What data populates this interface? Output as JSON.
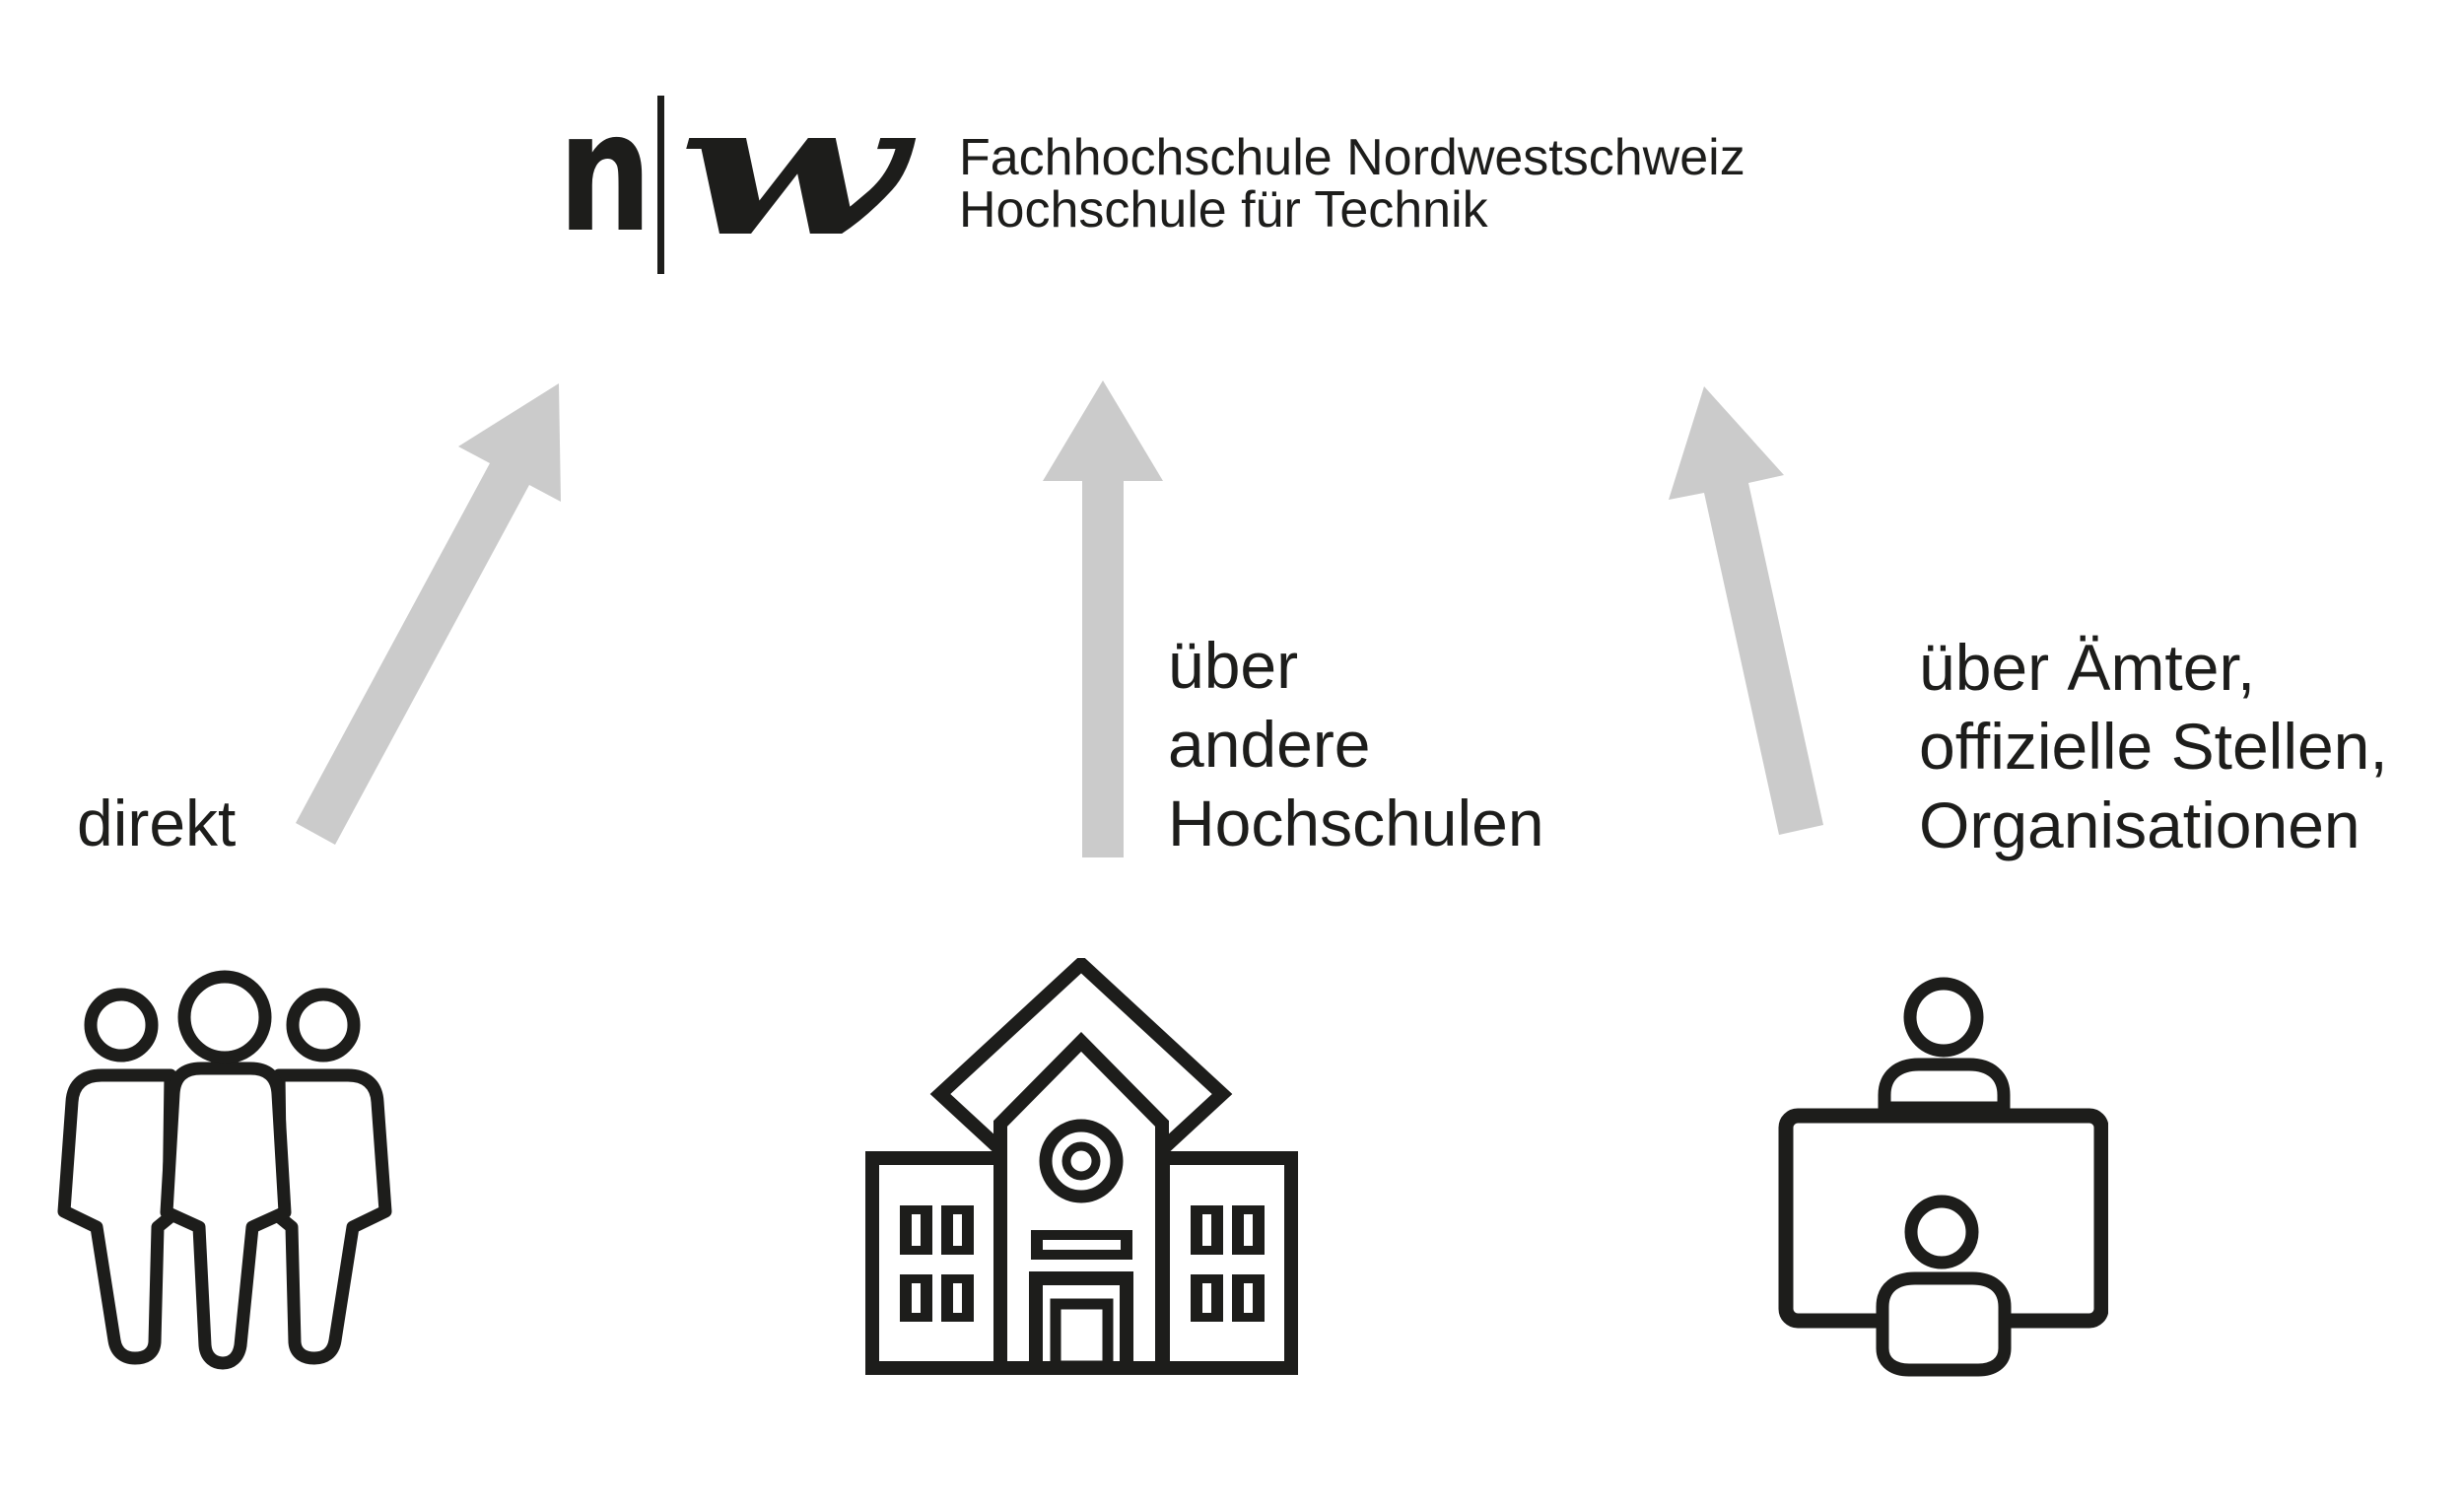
{
  "colors": {
    "ink": "#1d1d1b",
    "arrow": "#cbcbcb",
    "background": "#ffffff"
  },
  "logo": {
    "letter_n": "n",
    "letter_w": "w",
    "line1": "Fachhochschule Nordwestschweiz",
    "line2": "Hochschule für Technik"
  },
  "channels": [
    {
      "id": "direct",
      "label_lines": [
        "direkt"
      ],
      "icon": "people-group-icon"
    },
    {
      "id": "via-other-universities",
      "label_lines": [
        "über",
        "andere",
        "Hochschulen"
      ],
      "icon": "school-building-icon"
    },
    {
      "id": "via-offices",
      "label_lines": [
        "über Ämter,",
        "offizielle Stellen,",
        "Organisationen"
      ],
      "icon": "reception-desk-icon"
    }
  ]
}
